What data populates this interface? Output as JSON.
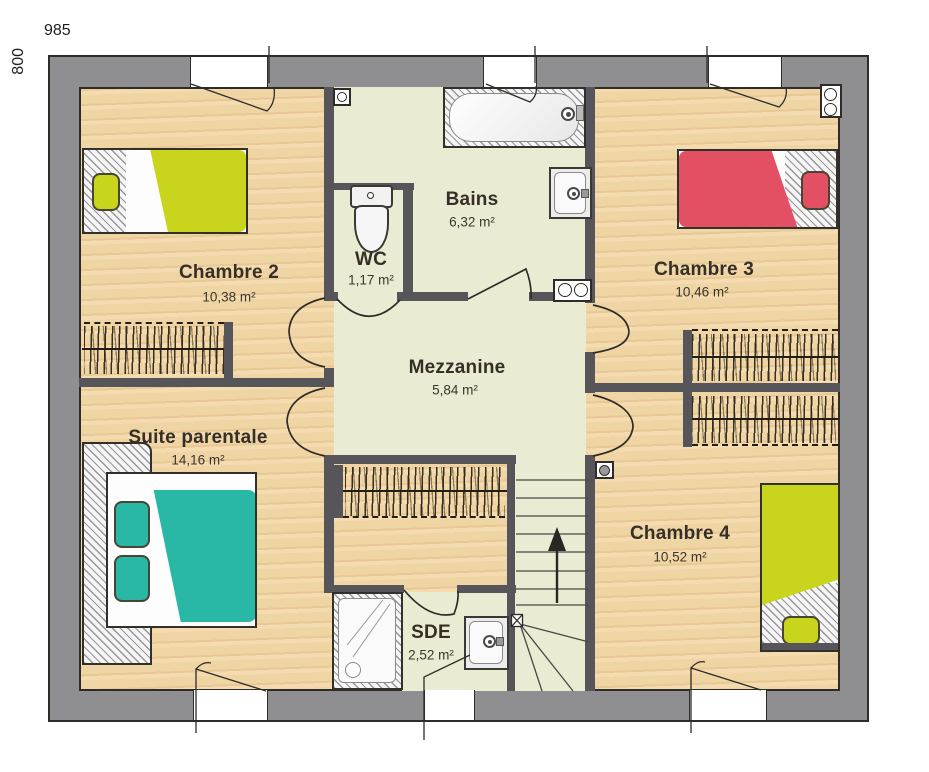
{
  "dims": {
    "width_label": "985",
    "height_label": "800"
  },
  "rooms": [
    {
      "id": "chambre2",
      "name": "Chambre 2",
      "area": "10,38 m²"
    },
    {
      "id": "wc",
      "name": "WC",
      "area": "1,17 m²"
    },
    {
      "id": "bains",
      "name": "Bains",
      "area": "6,32 m²"
    },
    {
      "id": "chambre3",
      "name": "Chambre 3",
      "area": "10,46 m²"
    },
    {
      "id": "mezzanine",
      "name": "Mezzanine",
      "area": "5,84 m²"
    },
    {
      "id": "suite",
      "name": "Suite parentale",
      "area": "14,16 m²"
    },
    {
      "id": "chambre4",
      "name": "Chambre 4",
      "area": "10,52 m²"
    },
    {
      "id": "sde",
      "name": "SDE",
      "area": "2,52 m²"
    }
  ],
  "colors": {
    "wall_outer": "#8f8f91",
    "wall_inner": "#56565a",
    "wood_floor": "#f0d5a4",
    "tile_floor": "#e9ecd2",
    "bed_yellow": "#c9d41c",
    "bed_red": "#e34f63",
    "bed_teal": "#29b7a6"
  }
}
